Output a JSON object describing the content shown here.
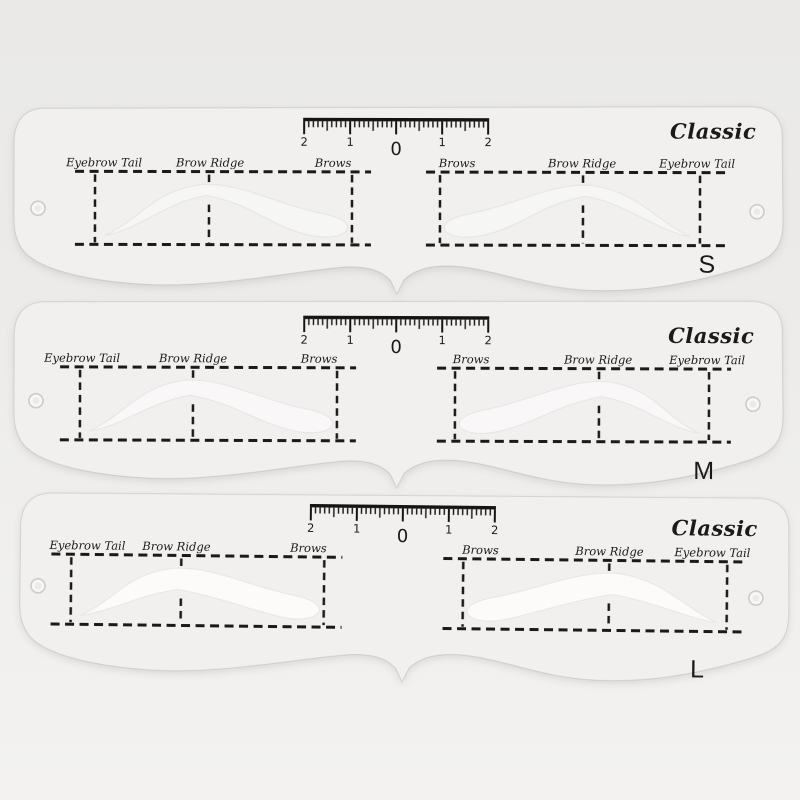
{
  "scene": {
    "description": "Three translucent plastic eyebrow grooming stencils stacked vertically on a light grey background, sizes S, M and L"
  },
  "colors": {
    "background": "#ECEBE9",
    "plastic": "#F1F0EE",
    "ink": "#1C1A18",
    "cutout": "#FCFBFA"
  },
  "stencils": [
    {
      "brand": "Classic",
      "size": "S",
      "labels_left": [
        "Eyebrow Tail",
        "Brow Ridge",
        "Brows"
      ],
      "labels_right": [
        "Brows",
        "Brow Ridge",
        "Eyebrow Tail"
      ],
      "ruler_numbers": [
        "2",
        "1",
        "0",
        "1",
        "2"
      ]
    },
    {
      "brand": "Classic",
      "size": "M",
      "labels_left": [
        "Eyebrow Tail",
        "Brow Ridge",
        "Brows"
      ],
      "labels_right": [
        "Brows",
        "Brow Ridge",
        "Eyebrow Tail"
      ],
      "ruler_numbers": [
        "2",
        "1",
        "0",
        "1",
        "2"
      ]
    },
    {
      "brand": "Classic",
      "size": "L",
      "labels_left": [
        "Eyebrow Tail",
        "Brow Ridge",
        "Brows"
      ],
      "labels_right": [
        "Brows",
        "Brow Ridge",
        "Eyebrow Tail"
      ],
      "ruler_numbers": [
        "2",
        "1",
        "0",
        "1",
        "2"
      ]
    }
  ]
}
